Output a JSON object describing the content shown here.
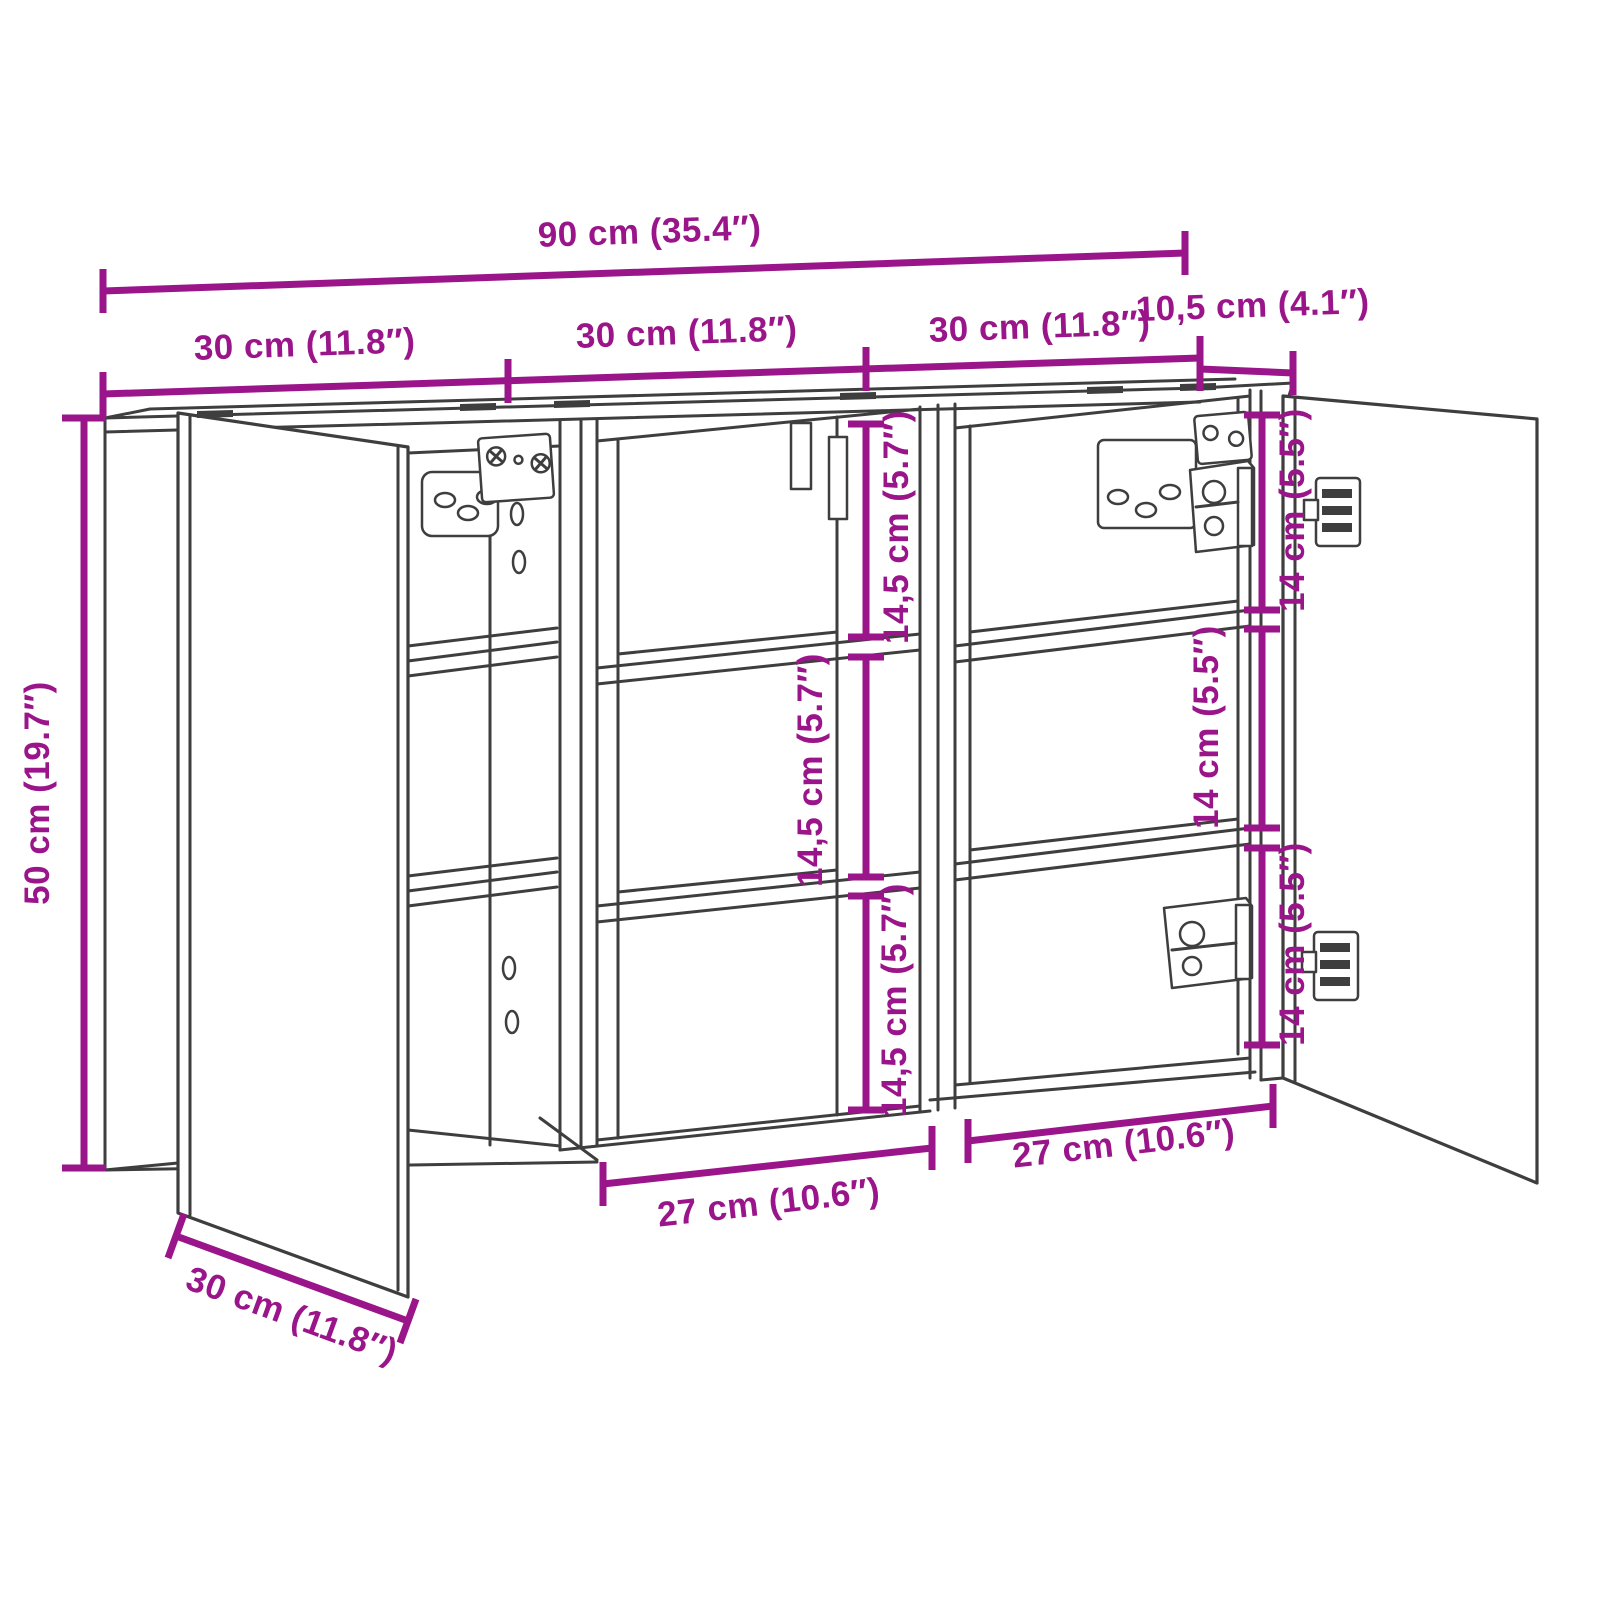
{
  "diagram": {
    "title": "cabinet-dimension-diagram",
    "subject": "three-door mirror wall cabinet technical drawing",
    "colors": {
      "dimension_accent": "#9a158a",
      "drawing_line": "#3e3e3e",
      "background": "#ffffff"
    },
    "dimensions": {
      "overall_width": "90 cm (35.4″)",
      "top_depth": "10,5 cm (4.1″)",
      "section_width_left": "30 cm (11.8″)",
      "section_width_middle": "30 cm (11.8″)",
      "section_width_right": "30 cm (11.8″)",
      "height": "50 cm (19.7″)",
      "depth": "30 cm (11.8″)",
      "middle_compartment_top": "14,5 cm (5.7″)",
      "middle_compartment_mid": "14,5 cm (5.7″)",
      "middle_compartment_bottom": "14,5 cm (5.7″)",
      "right_compartment_top": "14 cm (5.5″)",
      "right_compartment_mid": "14 cm (5.5″)",
      "right_compartment_bottom": "14 cm (5.5″)",
      "inner_width_middle": "27 cm (10.6″)",
      "inner_width_right": "27 cm (10.6″)"
    }
  }
}
